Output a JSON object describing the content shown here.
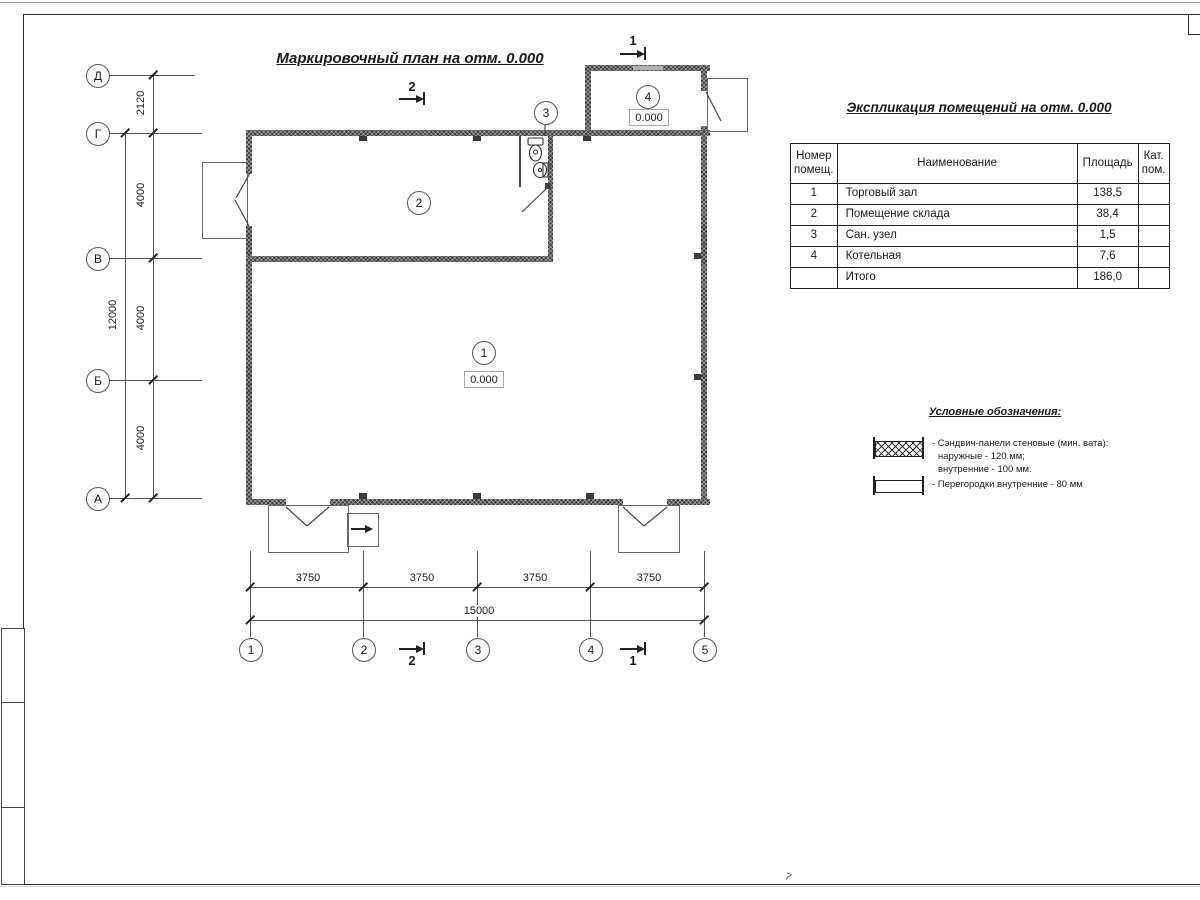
{
  "plan": {
    "title": "Маркировочный план на отм. 0.000",
    "rooms": [
      {
        "num": "1",
        "level": "0.000"
      },
      {
        "num": "2"
      },
      {
        "num": "3"
      },
      {
        "num": "4",
        "level": "0.000"
      }
    ],
    "row_axes": [
      "Д",
      "Г",
      "В",
      "Б",
      "А"
    ],
    "col_axes": [
      "1",
      "2",
      "3",
      "4",
      "5"
    ],
    "dims_left": {
      "dg": "2120",
      "gv": "4000",
      "vb": "4000",
      "ba": "4000",
      "total": "12000"
    },
    "dims_bottom": {
      "spans": [
        "3750",
        "3750",
        "3750",
        "3750"
      ],
      "total": "15000"
    },
    "sections": {
      "s1": "1",
      "s2": "2"
    }
  },
  "table": {
    "title": "Экспликация помещений на отм. 0.000",
    "headers": {
      "num_l1": "Номер",
      "num_l2": "помещ.",
      "name": "Наименование",
      "area": "Площадь",
      "cat_l1": "Кат.",
      "cat_l2": "пом."
    },
    "rows": [
      {
        "num": "1",
        "name": "Торговый зал",
        "area": "138,5",
        "cat": ""
      },
      {
        "num": "2",
        "name": "Помещение склада",
        "area": "38,4",
        "cat": ""
      },
      {
        "num": "3",
        "name": "Сан. узел",
        "area": "1,5",
        "cat": ""
      },
      {
        "num": "4",
        "name": "Котельная",
        "area": "7,6",
        "cat": ""
      },
      {
        "num": "",
        "name": "Итого",
        "area": "186,0",
        "cat": ""
      }
    ]
  },
  "legend": {
    "title": "Условные обозначения:",
    "items": [
      {
        "line1": "- Сэндвич-панели стеновые (мин. вата):",
        "line2": "наружные - 120 мм;",
        "line3": "внутренние - 100 мм."
      },
      {
        "line1": "- Перегородки внутренние - 80 мм"
      }
    ]
  },
  "sheet": {
    "page_mark": "7"
  }
}
